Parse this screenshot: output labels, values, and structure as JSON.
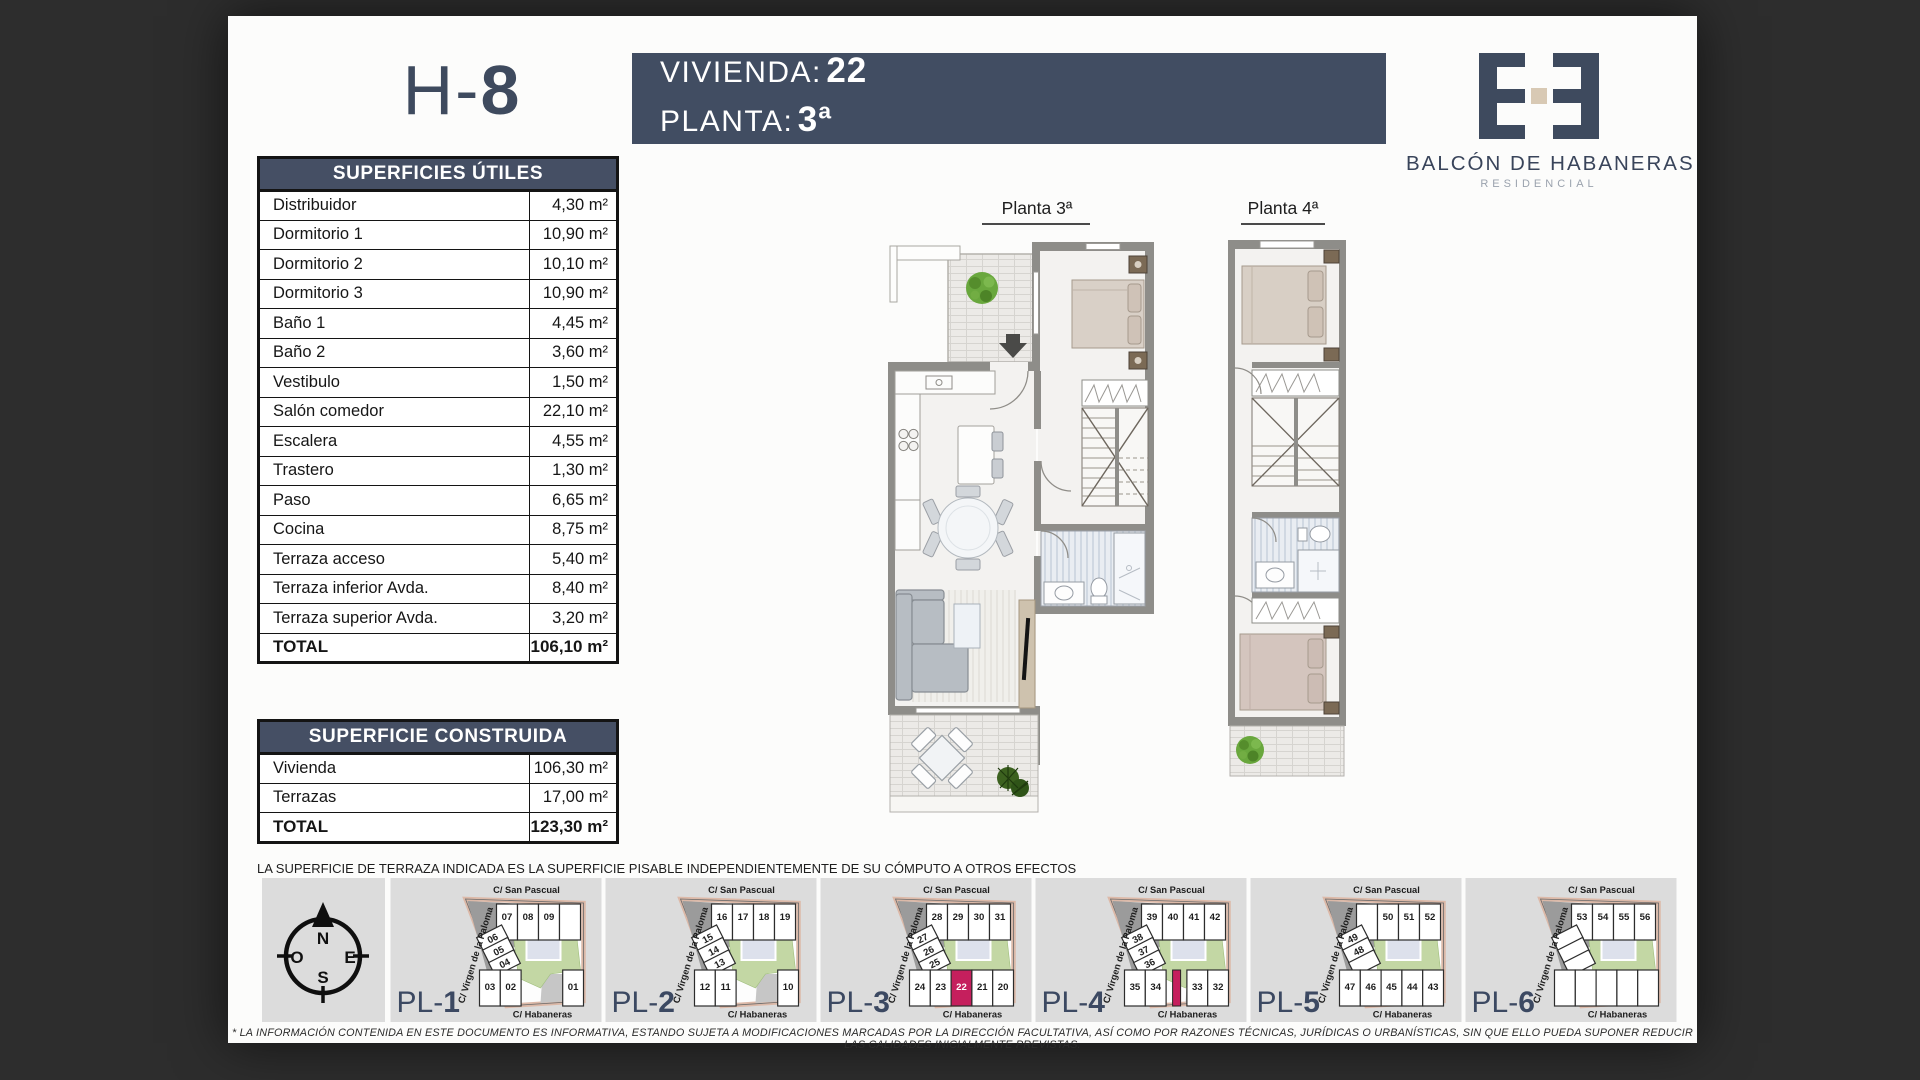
{
  "header": {
    "unit_code_prefix": "H-",
    "unit_code_number": "8",
    "vivienda_label": "VIVIENDA:",
    "vivienda_value": "22",
    "planta_label": "PLANTA:",
    "planta_value": "3ª",
    "brand_name": "BALCÓN DE HABANERAS",
    "brand_subtitle": "RESIDENCIAL"
  },
  "tables": {
    "superficies_utiles": {
      "title": "SUPERFICIES ÚTILES",
      "rows": [
        {
          "label": "Distribuidor",
          "value": "4,30 m²"
        },
        {
          "label": "Dormitorio 1",
          "value": "10,90 m²"
        },
        {
          "label": "Dormitorio 2",
          "value": "10,10 m²"
        },
        {
          "label": "Dormitorio 3",
          "value": "10,90 m²"
        },
        {
          "label": "Baño 1",
          "value": "4,45 m²"
        },
        {
          "label": "Baño 2",
          "value": "3,60 m²"
        },
        {
          "label": "Vestibulo",
          "value": "1,50 m²"
        },
        {
          "label": "Salón comedor",
          "value": "22,10 m²"
        },
        {
          "label": "Escalera",
          "value": "4,55 m²"
        },
        {
          "label": "Trastero",
          "value": "1,30 m²"
        },
        {
          "label": "Paso",
          "value": "6,65 m²"
        },
        {
          "label": "Cocina",
          "value": "8,75 m²"
        },
        {
          "label": "Terraza acceso",
          "value": "5,40 m²"
        },
        {
          "label": "Terraza inferior Avda.",
          "value": "8,40 m²"
        },
        {
          "label": "Terraza superior Avda.",
          "value": "3,20 m²"
        }
      ],
      "total": {
        "label": "TOTAL",
        "value": "106,10 m²"
      }
    },
    "superficie_construida": {
      "title": "SUPERFICIE CONSTRUIDA",
      "rows": [
        {
          "label": "Vivienda",
          "value": "106,30 m²"
        },
        {
          "label": "Terrazas",
          "value": "17,00 m²"
        }
      ],
      "total": {
        "label": "TOTAL",
        "value": "123,30 m²"
      }
    }
  },
  "plans": {
    "plan3_label": "Planta 3ª",
    "plan4_label": "Planta 4ª"
  },
  "footnote": "LA SUPERFICIE DE TERRAZA INDICADA ES LA SUPERFICIE PISABLE INDEPENDIENTEMENTE DE SU CÓMPUTO A OTROS EFECTOS",
  "disclaimer": "* LA INFORMACIÓN CONTENIDA EN ESTE DOCUMENTO ES INFORMATIVA, ESTANDO SUJETA A MODIFICACIONES MARCADAS POR LA DIRECCIÓN FACULTATIVA, ASÍ COMO POR RAZONES TÉCNICAS, JURÍDICAS O URBANÍSTICAS, SIN QUE ELLO PUEDA SUPONER REDUCIR LAS CALIDADES INICIALMENTE PREVISTAS.",
  "compass": {
    "n": "N",
    "s": "S",
    "e": "E",
    "o": "O"
  },
  "site_plans": [
    {
      "label_prefix": "PL-",
      "label_number": "1",
      "streets": {
        "top": "C/ San  Pascual",
        "left": "C/ Virgen de la Paloma",
        "bottom": "C/ Habaneras"
      },
      "top_row": [
        "07",
        "08",
        "09",
        ""
      ],
      "mid_row": [
        "06",
        "05",
        "04"
      ],
      "bottom_row": [
        "03",
        "02",
        null,
        null,
        "01"
      ],
      "highlight": null
    },
    {
      "label_prefix": "PL-",
      "label_number": "2",
      "streets": {
        "top": "C/ San  Pascual",
        "left": "C/ Virgen de la Paloma",
        "bottom": "C/ Habaneras"
      },
      "top_row": [
        "16",
        "17",
        "18",
        "19"
      ],
      "mid_row": [
        "15",
        "14",
        "13"
      ],
      "bottom_row": [
        "12",
        "11",
        null,
        null,
        "10"
      ],
      "highlight": null
    },
    {
      "label_prefix": "PL-",
      "label_number": "3",
      "streets": {
        "top": "C/ San  Pascual",
        "left": "C/ Virgen de la Paloma",
        "bottom": "C/ Habaneras"
      },
      "top_row": [
        "28",
        "29",
        "30",
        "31"
      ],
      "mid_row": [
        "27",
        "26",
        "25"
      ],
      "bottom_row": [
        "24",
        "23",
        "22",
        "21",
        "20"
      ],
      "highlight": "22"
    },
    {
      "label_prefix": "PL-",
      "label_number": "4",
      "streets": {
        "top": "C/ San  Pascual",
        "left": "C/ Virgen de la Paloma",
        "bottom": "C/ Habaneras"
      },
      "top_row": [
        "39",
        "40",
        "41",
        "42"
      ],
      "mid_row": [
        "38",
        "37",
        "36"
      ],
      "bottom_row": [
        "35",
        "34",
        "|",
        "33",
        "32"
      ],
      "highlight": null
    },
    {
      "label_prefix": "PL-",
      "label_number": "5",
      "streets": {
        "top": "C/ San  Pascual",
        "left": "C/ Virgen de la Paloma",
        "bottom": "C/ Habaneras"
      },
      "top_row": [
        "",
        "50",
        "51",
        "52"
      ],
      "mid_row": [
        "49",
        "48",
        ""
      ],
      "bottom_row": [
        "47",
        "46",
        "45",
        "44",
        "43"
      ],
      "highlight": null
    },
    {
      "label_prefix": "PL-",
      "label_number": "6",
      "streets": {
        "top": "C/ San  Pascual",
        "left": "C/ Virgen de la Paloma",
        "bottom": "C/ Habaneras"
      },
      "top_row": [
        "53",
        "54",
        "55",
        "56"
      ],
      "mid_row": [
        "",
        "",
        ""
      ],
      "bottom_row": [
        "",
        "",
        "",
        "",
        ""
      ],
      "highlight": null
    }
  ],
  "colors": {
    "accent": "#414d62",
    "table_header": "#454f64",
    "highlight_unit": "#c51f5d",
    "courtyard_green": "#c3d7a4",
    "street_pink": "#dcb9a8",
    "wall_gray": "#8e8d89"
  }
}
